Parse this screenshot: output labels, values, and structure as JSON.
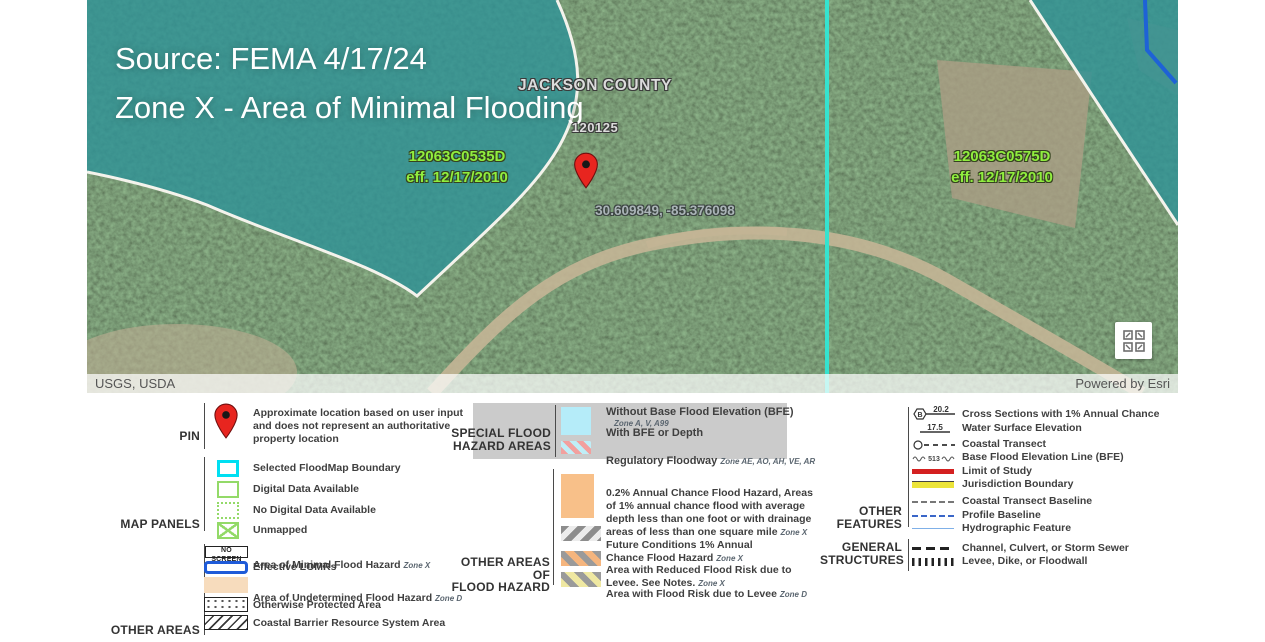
{
  "map": {
    "overlay_title": "Source: FEMA 4/17/24\nZone X - Area of Minimal Flooding",
    "county_label": "JACKSON COUNTY",
    "county_code": "120125",
    "panel_left": "12063C0535D\neff. 12/17/2010",
    "panel_right": "12063C0575D\neff. 12/17/2010",
    "pin_coordinates": "30.609849, -85.376098",
    "attribution_left": "USGS, USDA",
    "attribution_right": "Powered by Esri",
    "colors": {
      "panel_label_green": "#90ee3e",
      "selected_boundary_cyan": "#35e3cf",
      "flood_zone_teal": "#2f9396",
      "pin_red": "#e8251f",
      "hydrographic_blue": "#1e62d6"
    }
  },
  "legend": {
    "pin_section": {
      "label": "PIN",
      "description": "Approximate location based on user input\nand does not represent an authoritative\nproperty location"
    },
    "map_panels": {
      "label": "MAP PANELS",
      "items": [
        {
          "label": "Selected FloodMap Boundary"
        },
        {
          "label": "Digital Data Available"
        },
        {
          "label": "No Digital Data Available"
        },
        {
          "label": "Unmapped"
        }
      ]
    },
    "other_areas": {
      "label": "OTHER AREAS",
      "items": [
        {
          "swatch_text": "NO SCREEN",
          "label": "Area of Minimal Flood Hazard",
          "zone": "Zone X"
        },
        {
          "label": "Effective LOMRs",
          "zone": ""
        },
        {
          "label": "Area of Undetermined Flood Hazard",
          "zone": "Zone D"
        },
        {
          "label": "Otherwise Protected Area",
          "zone": ""
        },
        {
          "label": "Coastal Barrier Resource System Area",
          "zone": ""
        }
      ]
    },
    "special_flood_hazard_areas": {
      "label": "SPECIAL FLOOD\nHAZARD AREAS",
      "row1_title": "Without Base Flood Elevation (BFE)",
      "row1_zones": "Zone A, V, A99",
      "row2_title": "With BFE or Depth",
      "row3_title": "Regulatory Floodway",
      "row3_zones": "Zone AE, AO, AH, VE, AR"
    },
    "other_areas_of_flood_hazard": {
      "label": "OTHER AREAS OF\nFLOOD HAZARD",
      "items": [
        {
          "label": "0.2% Annual Chance Flood Hazard, Areas\nof 1% annual chance flood with average\ndepth less than one foot or with drainage\nareas of less than one square mile",
          "zone": "Zone X"
        },
        {
          "label": "Future Conditions 1% Annual\nChance Flood Hazard",
          "zone": "Zone X"
        },
        {
          "label": "Area with Reduced Flood Risk due to\nLevee. See Notes.",
          "zone": "Zone X"
        },
        {
          "label": "Area with Flood Risk due to Levee",
          "zone": "Zone D"
        }
      ]
    },
    "other_features": {
      "label": "OTHER\nFEATURES",
      "cross_section_value": "20.2",
      "cross_section_letter": "B",
      "water_surface_value": "17.5",
      "bfe_value": "513",
      "items": [
        {
          "label": "Cross Sections with 1% Annual Chance"
        },
        {
          "label": "Water Surface Elevation"
        },
        {
          "label": "Coastal Transect"
        },
        {
          "label": "Base Flood Elevation Line (BFE)"
        },
        {
          "label": "Limit of Study"
        },
        {
          "label": "Jurisdiction Boundary"
        },
        {
          "label": "Coastal Transect Baseline"
        },
        {
          "label": "Profile Baseline"
        },
        {
          "label": "Hydrographic Feature"
        }
      ]
    },
    "general_structures": {
      "label": "GENERAL\nSTRUCTURES",
      "items": [
        {
          "label": "Channel, Culvert, or Storm Sewer"
        },
        {
          "label": "Levee, Dike, or Floodwall"
        }
      ]
    }
  }
}
